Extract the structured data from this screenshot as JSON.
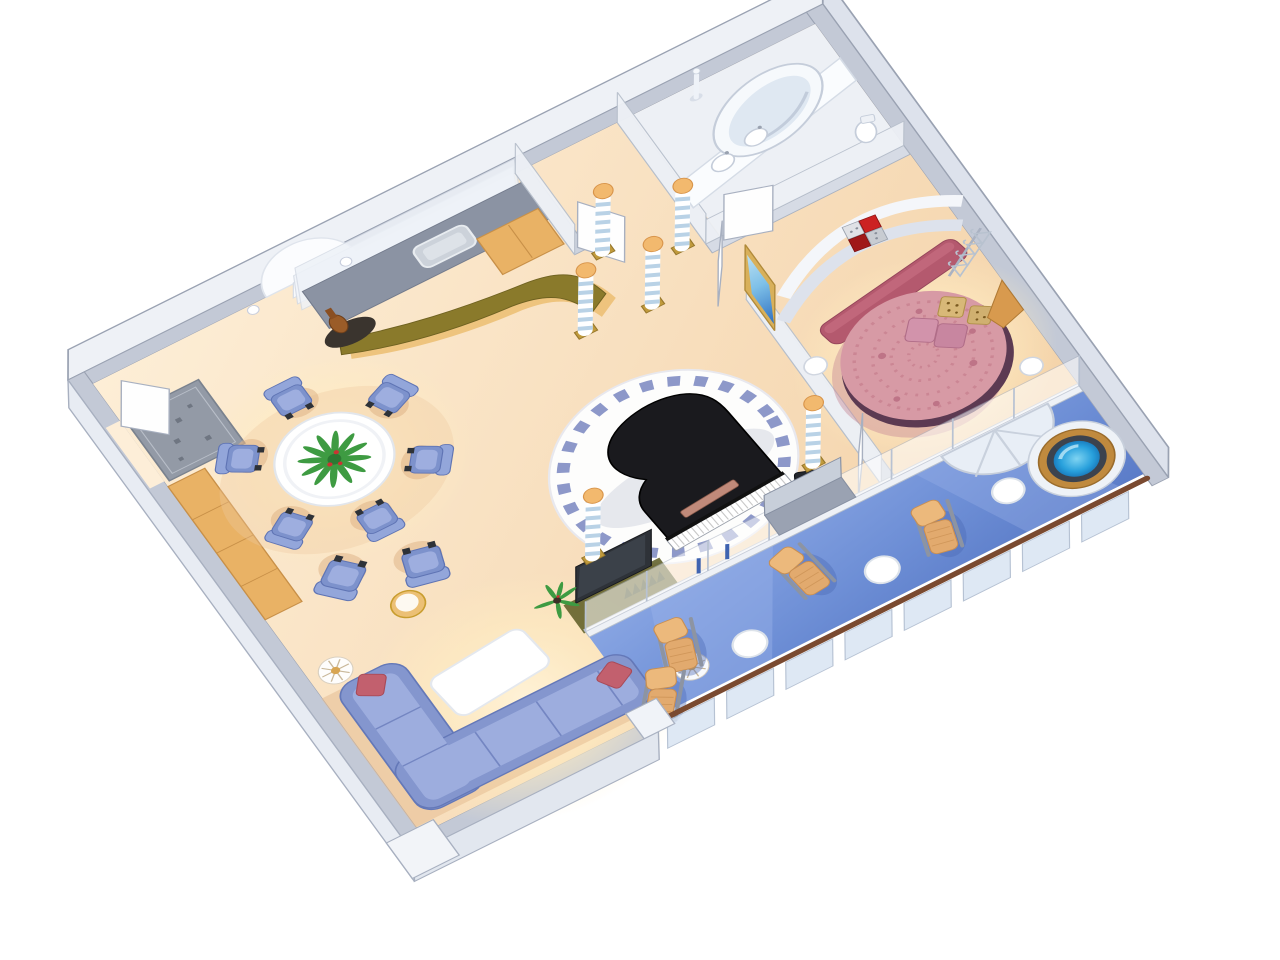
{
  "scene": {
    "kind": "isometric cutaway floor plan illustration",
    "subject": "luxury ship suite with grand piano, bedroom, bathroom and private balcony with whirlpool",
    "background": "#ffffff"
  },
  "inventory": {
    "dining_chairs": 6,
    "armchairs": 2,
    "lounge_chairs": 4,
    "balcony_tables": 3,
    "striped_columns": 6,
    "sectional_sofas": 1,
    "round_beds": 1,
    "grand_pianos": 1,
    "whirlpool_tubs": 1,
    "bathtubs": 1,
    "framed_artworks": 2,
    "floor_lamps": 2,
    "plants": 3,
    "door_leaves": 5,
    "railing_glass_panels": 8,
    "bed_pillows": 4,
    "wall_sconces": 2
  },
  "colors": {
    "floor_peach": "#f8dfbe",
    "floor_light": "#fdeed8",
    "balcony_blue": "#6e8fd6",
    "balcony_light": "#9ab2e8",
    "wall_gray": "#c3c9d6",
    "wall_face": "#eef1f6",
    "sofa_blue": "#8496ce",
    "sofa_cushion": "#9dadde",
    "chair_blue": "#7d92cc",
    "chair_back": "#93a6da",
    "pillow_red": "#c2606e",
    "bed_pink": "#d79aa5",
    "bed_base": "#5c3a52",
    "headboard_pink": "#b4596e",
    "piano_black": "#1a1a1e",
    "tile_blue": "#8d98c9",
    "bar_olive": "#8a7a2b",
    "wood_tan": "#e9b265",
    "gold": "#ecc075",
    "counter_gray": "#8b93a3",
    "lounge_tan": "#e2aa6e",
    "railing_brown": "#7a4a30",
    "jacuzzi_water": "#28a0dc",
    "jacuzzi_rim": "#3c434e",
    "jacuzzi_surround": "#c08a3e",
    "plant_green": "#3e9b42",
    "art_red": "#cc2222",
    "art_blue_sky": "#7ec0e8",
    "art_blue_sea": "#2e6fc0",
    "column_cap": "#f2b96e",
    "column_stripe": "#b9d2e6",
    "glass_blue": "#d9e4f3"
  }
}
